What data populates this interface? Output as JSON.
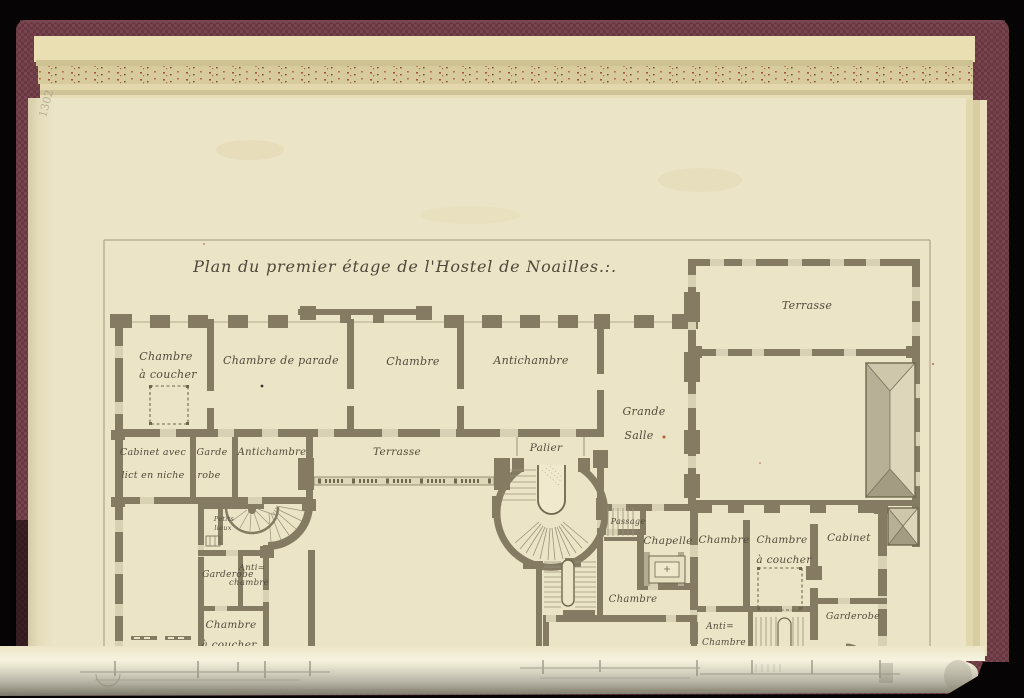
{
  "book": {
    "cover_color": "#6e3b44",
    "page_color": "#ece4c6",
    "wall_ink_color": "#847b62",
    "pencil_mark": "1302"
  },
  "plan": {
    "title": "Plan du premier étage de l'Hostel de Noailles.:.",
    "rooms": {
      "chambre_coucher_tl": [
        "Chambre",
        "à coucher"
      ],
      "chambre_parade": [
        "Chambre de parade"
      ],
      "chambre_top": [
        "Chambre"
      ],
      "antichambre_top": [
        "Antichambre"
      ],
      "grande_salle": [
        "Grande",
        "Salle"
      ],
      "terrasse_ne": [
        "Terrasse"
      ],
      "cabinet_niche": [
        "Cabinet avec",
        "lict en niche"
      ],
      "garde_robe_w": [
        "Garde",
        "robe"
      ],
      "antichambre_w": [
        "Antichambre"
      ],
      "terrasse_mid": [
        "Terrasse"
      ],
      "palier": [
        "Palier"
      ],
      "petits_lieux": [
        "Petits",
        "lieux"
      ],
      "garderobe_sw": [
        "Garderobe"
      ],
      "antichambre_sw": [
        "Anti=",
        "chambre"
      ],
      "chambre_coucher_sw": [
        "Chambre",
        "à coucher"
      ],
      "passage": [
        "Passage"
      ],
      "chapelle": [
        "Chapelle"
      ],
      "chambre_center": [
        "Chambre"
      ],
      "chambre_se1": [
        "Chambre"
      ],
      "chambre_coucher_se": [
        "Chambre",
        "à coucher"
      ],
      "cabinet_se": [
        "Cabinet"
      ],
      "antichambre_se": [
        "Anti=",
        "Chambre"
      ],
      "garderobe_se": [
        "Garderobe"
      ]
    }
  }
}
